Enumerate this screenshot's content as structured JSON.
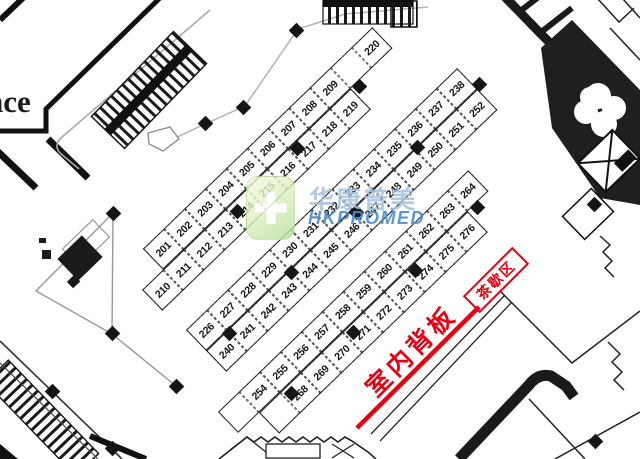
{
  "labels": {
    "entrance_partial": "nce",
    "indoor_backboard": "室内背板",
    "tea_break": "茶歇区"
  },
  "watermark": {
    "cn": "华康普美",
    "en": "HKPROMED",
    "logo": "green-cross-logo"
  },
  "colors": {
    "annotation_red": "#e60012",
    "watermark_blue": "#4c8ccc",
    "watermark_light_blue": "#a5c1dc",
    "logo_green": "#cdeab2",
    "wall_black": "#1a1a1a"
  },
  "floorplan": {
    "bands": [
      {
        "id": "band-1",
        "rows": [
          {
            "start": 1,
            "labels": [
              "201",
              "202",
              "203",
              "204",
              "205",
              "206",
              "207",
              "208",
              "209",
              "",
              "220"
            ]
          },
          {
            "start": 0,
            "labels": [
              "210",
              "211",
              "212",
              "213",
              "214",
              "215",
              "216",
              "217",
              "218",
              "219"
            ]
          }
        ]
      },
      {
        "id": "band-2",
        "rows": [
          {
            "start": 0,
            "labels": [
              "226",
              "227",
              "228",
              "229",
              "230",
              "231",
              "232",
              "233",
              "234",
              "235",
              "236",
              "237",
              "238"
            ]
          },
          {
            "start": 0,
            "labels": [
              "240",
              "241",
              "242",
              "243",
              "244",
              "245",
              "246",
              "247",
              "248",
              "249",
              "250",
              "251",
              "252"
            ]
          }
        ]
      },
      {
        "id": "band-3",
        "rows": [
          {
            "start": 0,
            "labels": [
              "",
              "254",
              "255",
              "256",
              "257",
              "258",
              "259",
              "260",
              "261",
              "262",
              "263",
              "264"
            ]
          },
          {
            "start": 1,
            "labels": [
              "",
              "268",
              "269",
              "270",
              "271",
              "272",
              "273",
              "274",
              "275",
              "276"
            ]
          }
        ]
      }
    ],
    "pillars": [
      [
        296,
        30
      ],
      [
        205,
        123
      ],
      [
        243,
        107
      ],
      [
        359,
        86
      ],
      [
        297,
        148
      ],
      [
        237,
        211
      ],
      [
        356,
        212
      ],
      [
        417,
        147
      ],
      [
        479,
        84
      ],
      [
        477,
        207
      ],
      [
        291,
        272
      ],
      [
        229,
        333
      ],
      [
        176,
        386
      ],
      [
        291,
        393
      ],
      [
        415,
        270
      ],
      [
        353,
        332
      ],
      [
        52,
        391
      ],
      [
        112,
        448
      ],
      [
        594,
        204
      ],
      [
        595,
        441
      ],
      [
        113,
        213
      ],
      [
        112,
        333
      ]
    ]
  }
}
